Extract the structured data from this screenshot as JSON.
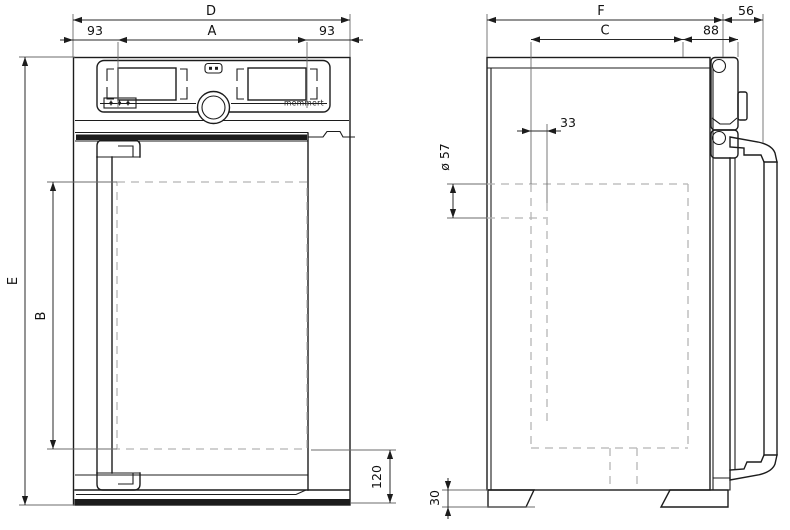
{
  "front_view": {
    "dim_width_total": "D",
    "dim_width_left": "93",
    "dim_width_inner": "A",
    "dim_width_right": "93",
    "dim_height_total": "E",
    "dim_height_inner": "B",
    "dim_base_height": "120",
    "panel_brand": "memmert"
  },
  "side_view": {
    "dim_depth_total": "F",
    "dim_door_depth": "56",
    "dim_depth_inner": "C",
    "dim_front_offset": "88",
    "dim_port_offset": "33",
    "dim_port_diameter": "ø 57",
    "dim_foot_height": "30"
  }
}
